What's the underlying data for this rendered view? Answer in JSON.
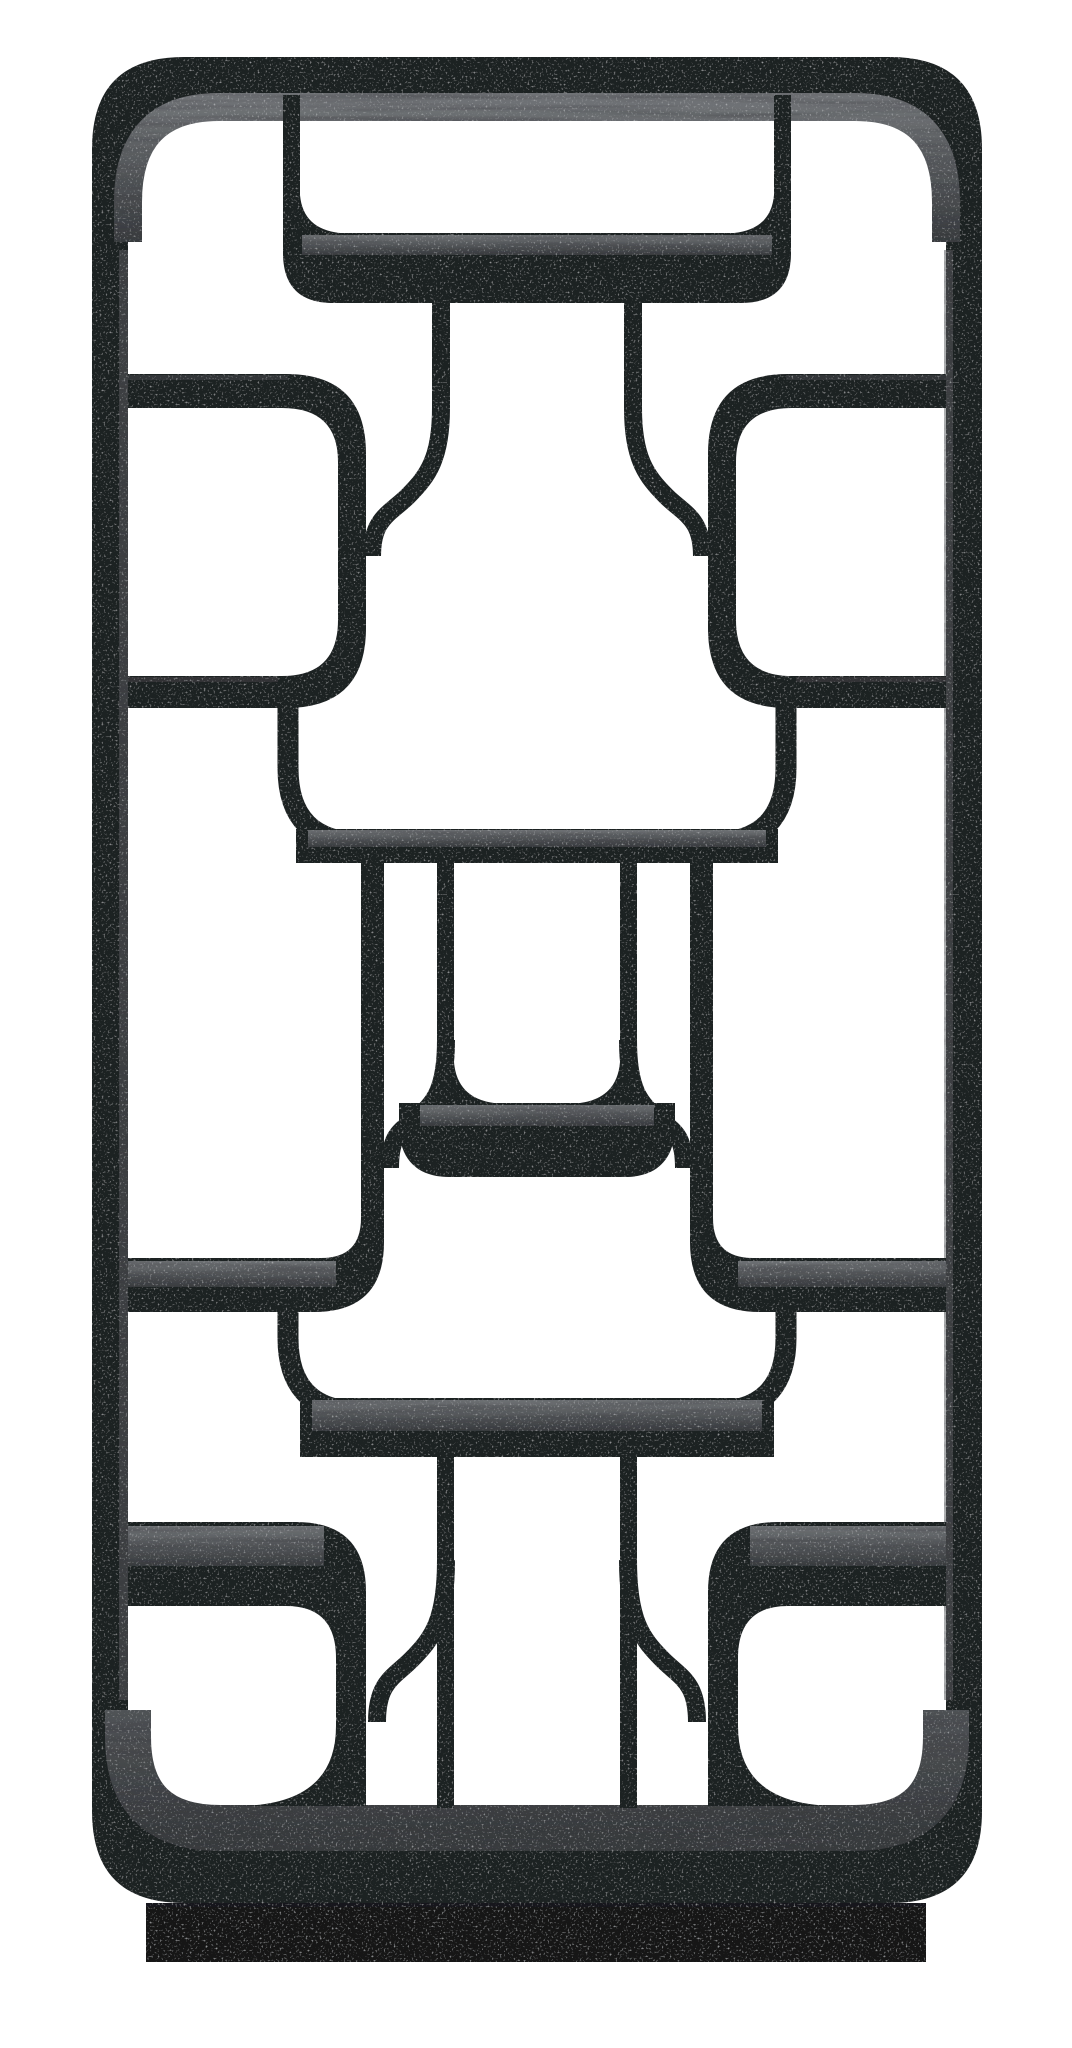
{
  "image": {
    "kind": "product photograph",
    "alt": "Tall black wooden geometric etagere display bookcase with a rounded rectangular outer frame, mirror-symmetric lattice of curved interlocking shelf compartments, hanging center channels, S-curved brackets and thin dividers, standing on a recessed rectangular plinth base against a plain white background",
    "background": "#ffffff"
  },
  "object": {
    "name": "geometric-etagere-bookcase",
    "finish": "black wash wood with visible grain on shelf tops",
    "symmetry": "mirrored about vertical centerline",
    "shelf_slab_count": 8,
    "hanging_channel_count": 2,
    "side_bracket_count": 6,
    "ogee_bracket_count": 6,
    "thin_divider_count": 6,
    "base": "recessed plinth"
  },
  "colors": {
    "background": "#ffffff",
    "wood_dark": "#1f2124",
    "wood_dark_deep": "#17181a",
    "wood_light_hi": "#6e7174",
    "wood_light_mid": "#505356",
    "wood_light_lo": "#383b3e",
    "plinth": "#131416",
    "sliver": "#5a5d60"
  },
  "canvas": {
    "width": 1072,
    "height": 2048
  }
}
